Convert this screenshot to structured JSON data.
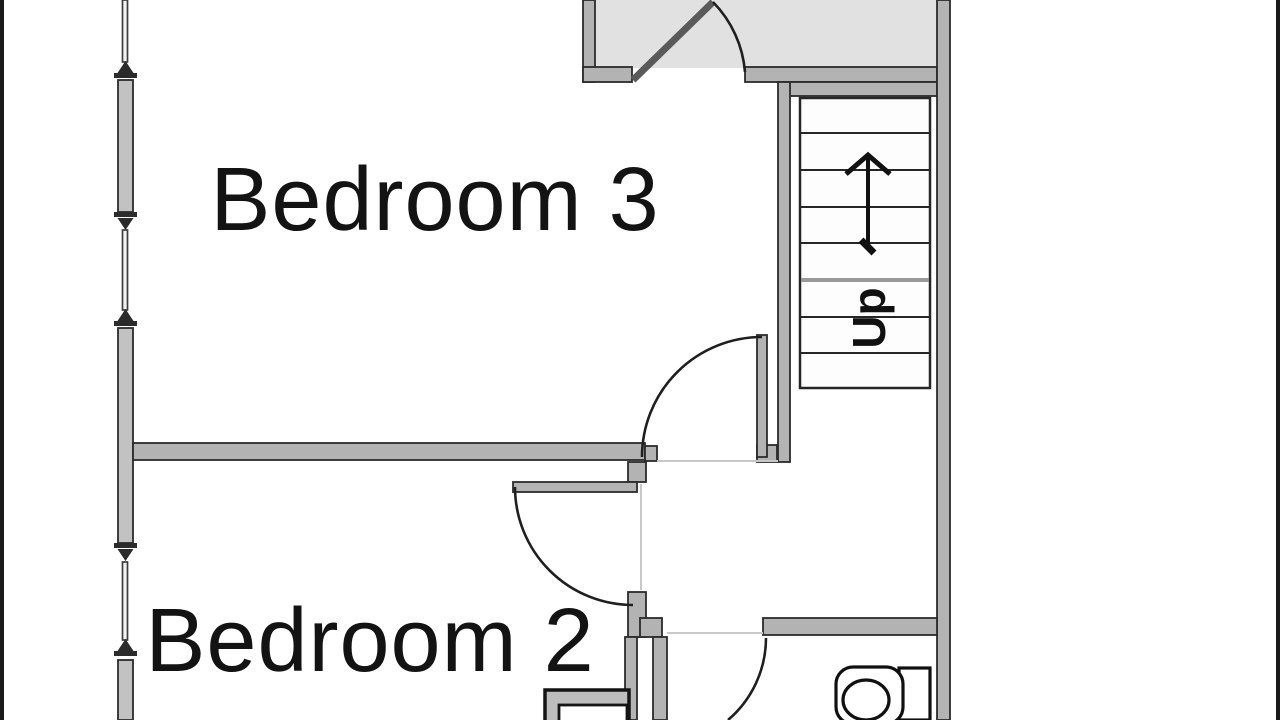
{
  "floorplan": {
    "labels": {
      "bedroom3": "Bedroom 3",
      "bedroom2": "Bedroom 2",
      "stairs_direction": "Up"
    },
    "rooms": [
      {
        "name": "Bedroom 3"
      },
      {
        "name": "Bedroom 2"
      }
    ],
    "stairs": {
      "label": "Up",
      "treads_visible": 8,
      "arrow": "up"
    },
    "colors": {
      "background": "#ffffff",
      "wall_fill": "#b3b3b3",
      "wall_outline": "#2b2b2b",
      "landing_fill": "#e1e1e1",
      "window_fill": "#c2c2c2",
      "door_arc": "#1f1f1f",
      "faint_line": "#c8c8c8",
      "label_text": "#131313",
      "edge_bar": "#1a1a1a"
    }
  }
}
